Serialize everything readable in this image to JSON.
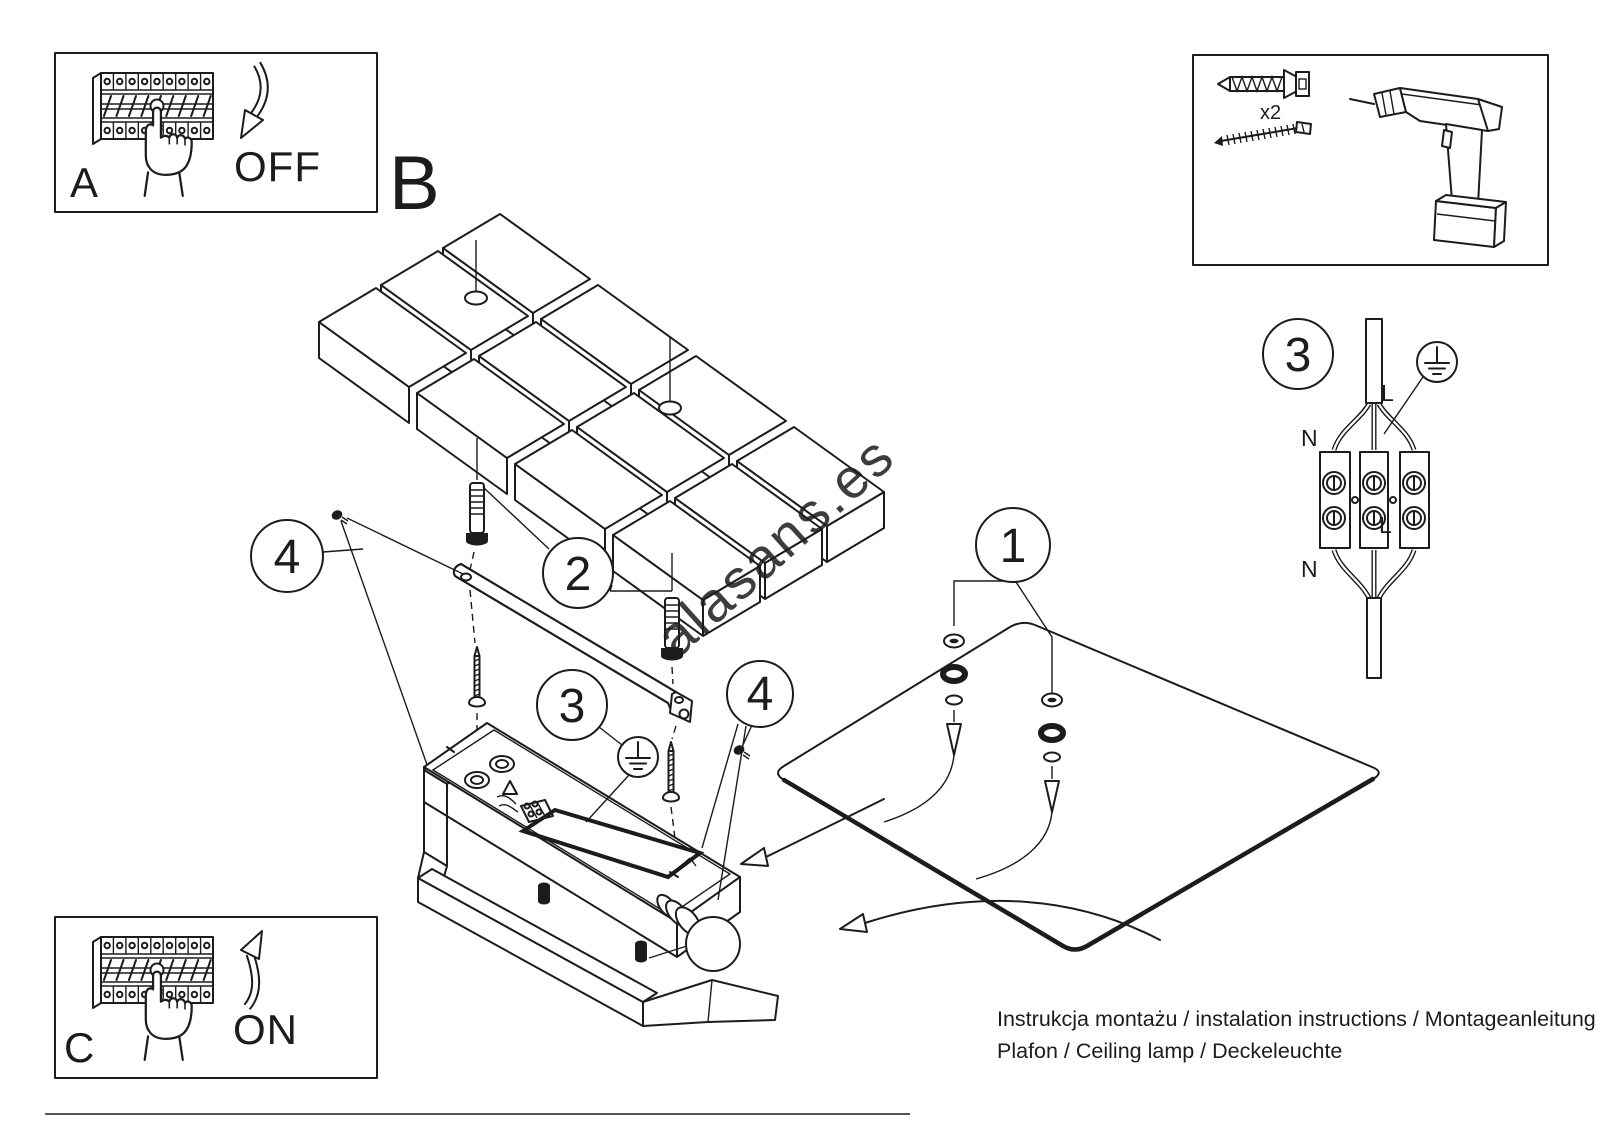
{
  "colors": {
    "ink": "#1c1c1c",
    "watermark": "#c9c9c9",
    "paper": "#ffffff"
  },
  "watermark": {
    "text": "alasans.es"
  },
  "footer": {
    "line1": "Instrukcja montażu / instalation instructions / Montageanleitung",
    "line2": "Plafon / Ceiling lamp / Deckeleuchte"
  },
  "power_off_box": {
    "label": "A",
    "state": "OFF"
  },
  "power_on_box": {
    "label": "C",
    "state": "ON"
  },
  "section_label": "B",
  "tools": {
    "anchor_count": "x2"
  },
  "callouts": {
    "c1": "1",
    "c2": "2",
    "c3": "3",
    "c4": "4"
  },
  "wiring": {
    "callout": "3",
    "n_top": "N",
    "l_top": "L",
    "n_bottom": "N",
    "l_bottom": "L"
  },
  "tile_grid": {
    "rows": 3,
    "cols": 4
  }
}
